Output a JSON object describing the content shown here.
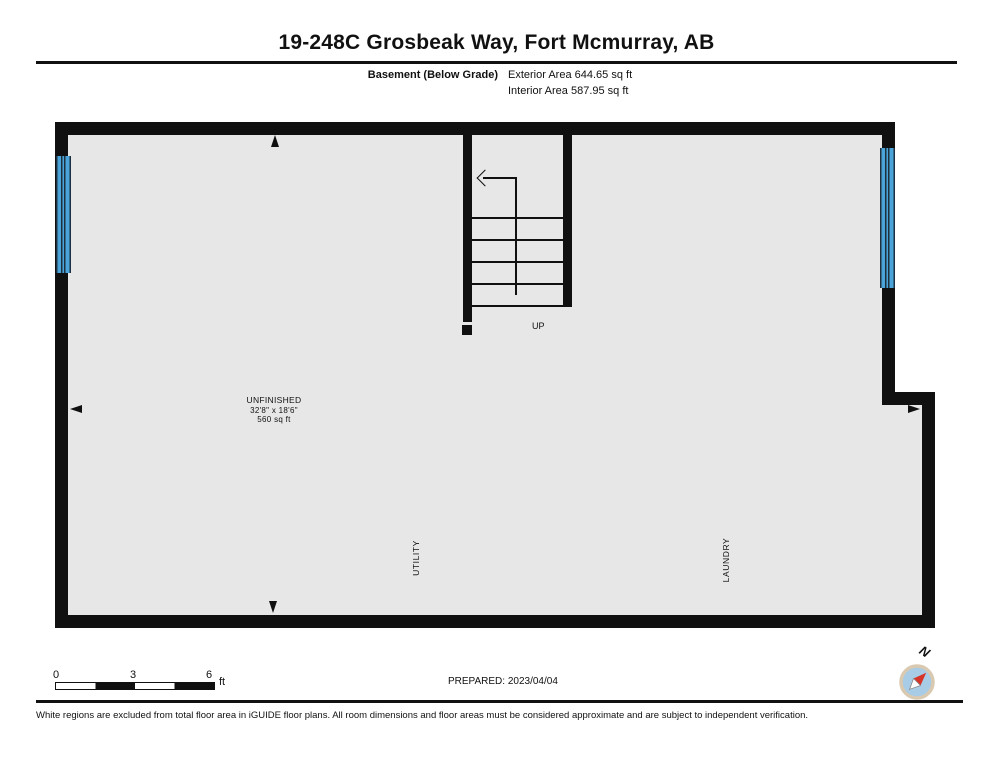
{
  "header": {
    "title": "19-248C Grosbeak Way, Fort Mcmurray, AB",
    "floor_label": "Basement (Below Grade)",
    "exterior_area": "Exterior Area 644.65 sq ft",
    "interior_area": "Interior Area 587.95 sq ft"
  },
  "plan": {
    "room": {
      "name": "UNFINISHED",
      "dimensions": "32'8\" x 18'6\"",
      "area": "560 sq ft"
    },
    "up_label": "UP",
    "utility_label": "UTILITY",
    "laundry_label": "LAUNDRY"
  },
  "footer": {
    "scale": {
      "ticks": [
        "0",
        "3",
        "6"
      ],
      "unit": "ft"
    },
    "prepared": "PREPARED: 2023/04/04",
    "compass_n": "N",
    "disclaimer": "White regions are excluded from total floor area in iGUIDE floor plans. All room dimensions and floor areas must be considered approximate and are subject to independent verification."
  },
  "colors": {
    "wall": "#101010",
    "interior_fill": "#e7e7e7",
    "window_blue": "#4aa3d9",
    "window_frame": "#1d3040",
    "compass_face": "#a9cce6",
    "compass_ring": "#d9c9b0",
    "compass_needle_red": "#d63428"
  }
}
